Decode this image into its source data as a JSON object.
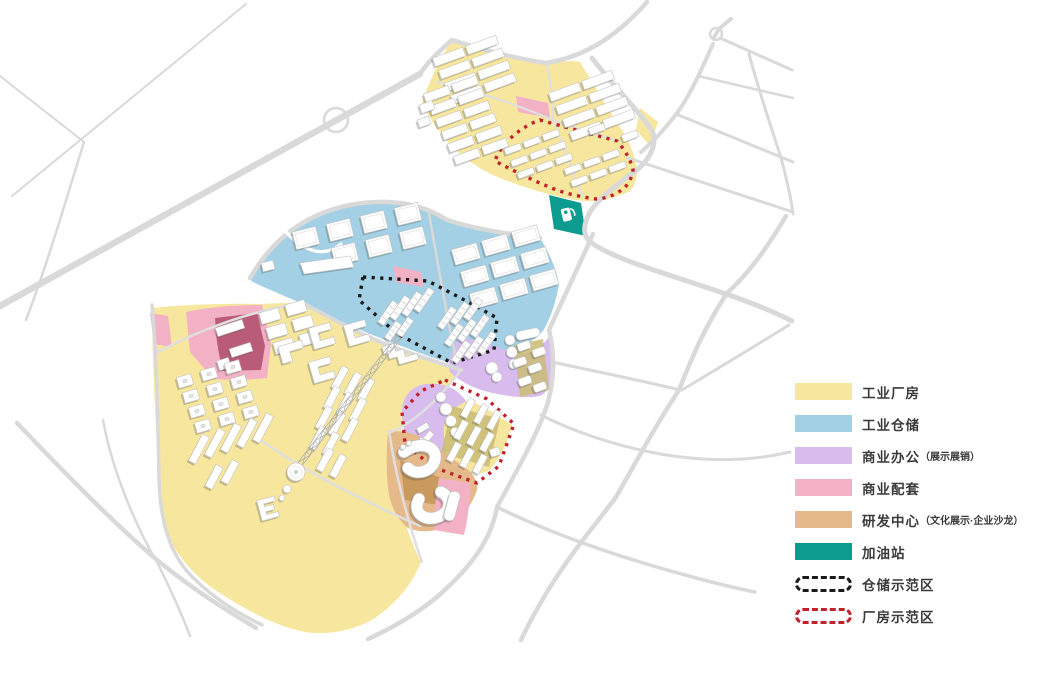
{
  "colors": {
    "background": "#FFFFFF",
    "industrial_factory": "#F7E79E",
    "industrial_storage": "#A3D0E4",
    "commercial_office": "#D9BCEE",
    "commercial_support": "#F2B1C4",
    "rd_center": "#E5B98A",
    "gas_station": "#0D9B90",
    "storage_demo": "#1A1A1A",
    "factory_demo": "#C2202A",
    "road": "#D9D9D9",
    "road_minor": "#DFDFDF",
    "building_fill": "#FFFFFF",
    "building_stroke": "#C2C2C2",
    "pad": "#C9BC72",
    "maroon": "#BA5C78",
    "dark_tan": "#C89A5E"
  },
  "icons": {
    "gas_station": "fuel-pump-icon"
  },
  "legend": {
    "items": [
      {
        "id": "industrial-factory",
        "label": "工业厂房",
        "swatch": "fill",
        "color_key": "industrial_factory"
      },
      {
        "id": "industrial-storage",
        "label": "工业仓储",
        "swatch": "fill",
        "color_key": "industrial_storage"
      },
      {
        "id": "commercial-office",
        "label": "商业办公",
        "sublabel": "（展示展销）",
        "swatch": "fill",
        "color_key": "commercial_office"
      },
      {
        "id": "commercial-support",
        "label": "商业配套",
        "swatch": "fill",
        "color_key": "commercial_support"
      },
      {
        "id": "rd-center",
        "label": "研发中心",
        "sublabel": "（文化展示·企业沙龙）",
        "swatch": "fill",
        "color_key": "rd_center"
      },
      {
        "id": "gas-station",
        "label": "加油站",
        "swatch": "fill",
        "color_key": "gas_station"
      },
      {
        "id": "storage-demo",
        "label": "仓储示范区",
        "swatch": "dashed",
        "color_key": "storage_demo"
      },
      {
        "id": "factory-demo",
        "label": "厂房示范区",
        "swatch": "dashed",
        "color_key": "factory_demo"
      }
    ]
  }
}
